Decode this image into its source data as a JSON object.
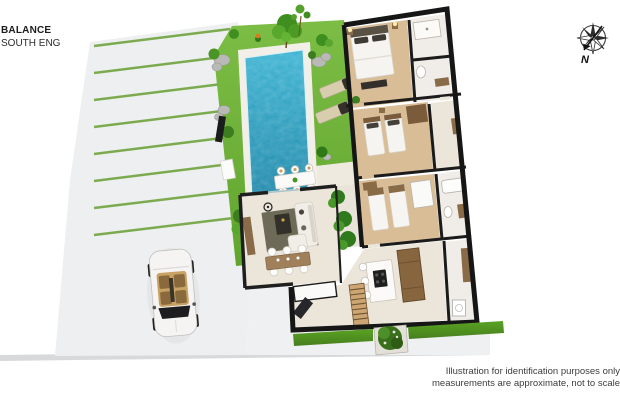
{
  "header": {
    "project_name": "BALANCE",
    "subtitle": "SOUTH ENG"
  },
  "compass": {
    "label": "N",
    "direction": "north-pointing-southwest"
  },
  "disclaimer": {
    "line1": "Illustration for identification purposes only",
    "line2": "measurements are approximate, not to scale"
  },
  "palette": {
    "lawn": "#6fb23a",
    "pool_water": "#2ba4c6",
    "pool_water_deep": "#1d87a8",
    "pool_deck": "#f2efe8",
    "pavement": "#edeff1",
    "parking_stripe": "#7cab4f",
    "wall": "#1b1b1b",
    "wood_floor": "#d9bd97",
    "tile_floor": "#ece5d9",
    "wood_furniture": "#8a6b47",
    "hedge": "#53981f",
    "car_body": "#f5f4f2",
    "car_interior": "#c8a264"
  },
  "floorplan": {
    "type": "3d-isometric-floor-plan",
    "outdoor_features": [
      "driveway with parking stripes",
      "parked convertible car",
      "lawn",
      "swimming pool",
      "pool deck",
      "two sun loungers",
      "rocks and shrubs",
      "trees",
      "outdoor dining table with six stools",
      "hedge strips",
      "square planter"
    ],
    "rooms": [
      "master bedroom",
      "ensuite shower room",
      "bathroom",
      "twin bedroom",
      "hallway",
      "third bedroom",
      "bathroom with tub",
      "living room",
      "kitchen with island",
      "stairs",
      "utility room",
      "entry hall"
    ]
  }
}
